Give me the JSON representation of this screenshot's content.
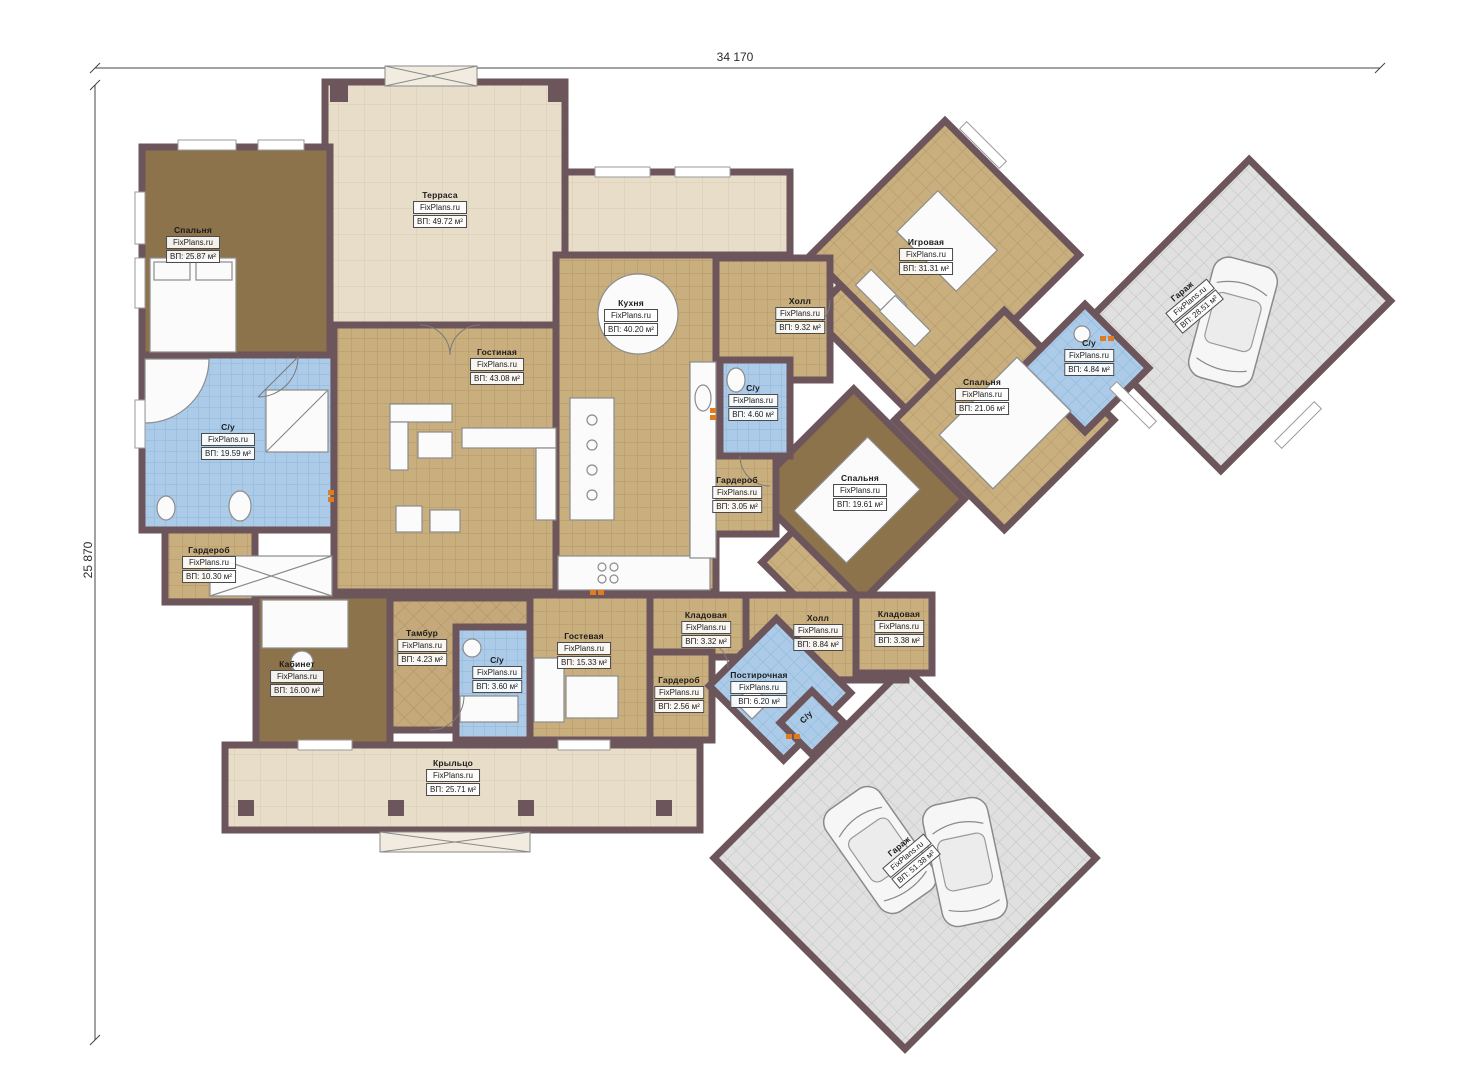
{
  "watermark": "FixPlans.ru",
  "dimensions": {
    "width_label": "34 170",
    "height_label": "25 870"
  },
  "colors": {
    "wall": "#6d565b",
    "tile_floor": "#c9ae7e",
    "bedroom_floor": "#8c734c",
    "bath_floor": "#abcbe9",
    "terrace_floor": "#e8ddc8",
    "garage_floor": "#e0e0e0",
    "marker_orange": "#e07b20"
  },
  "rooms": [
    {
      "name": "Спальня",
      "area": "ВП: 25.87 м²"
    },
    {
      "name": "Терраса",
      "area": "ВП: 49.72 м²"
    },
    {
      "name": "Гостиная",
      "area": "ВП: 43.08 м²"
    },
    {
      "name": "Кухня",
      "area": "ВП: 40.20 м²"
    },
    {
      "name": "Холл",
      "area": "ВП: 9.32 м²"
    },
    {
      "name": "Игровая",
      "area": "ВП: 31.31 м²"
    },
    {
      "name": "С/у",
      "area": "ВП: 4.84 м²"
    },
    {
      "name": "Гараж",
      "area": "ВП: 28.51 м²"
    },
    {
      "name": "Спальня",
      "area": "ВП: 21.06 м²"
    },
    {
      "name": "С/у",
      "area": "ВП: 4.60 м²"
    },
    {
      "name": "Гардероб",
      "area": "ВП: 3.05 м²"
    },
    {
      "name": "Спальня",
      "area": "ВП: 19.61 м²"
    },
    {
      "name": "С/у",
      "area": "ВП: 19.59 м²"
    },
    {
      "name": "Гардероб",
      "area": "ВП: 10.30 м²"
    },
    {
      "name": "Кабинет",
      "area": "ВП: 16.00 м²"
    },
    {
      "name": "Тамбур",
      "area": "ВП: 4.23 м²"
    },
    {
      "name": "С/у",
      "area": "ВП: 3.60 м²"
    },
    {
      "name": "Гостевая",
      "area": "ВП: 15.33 м²"
    },
    {
      "name": "Гардероб",
      "area": "ВП: 2.56 м²"
    },
    {
      "name": "Кладовая",
      "area": "ВП: 3.32 м²"
    },
    {
      "name": "Постирочная",
      "area": "ВП: 6.20 м²"
    },
    {
      "name": "Холл",
      "area": "ВП: 8.84 м²"
    },
    {
      "name": "Кладовая",
      "area": "ВП: 3.38 м²"
    },
    {
      "name": "Крыльцо",
      "area": "ВП: 25.71 м²"
    },
    {
      "name": "Гараж",
      "area": "ВП: 51.38 м²"
    },
    {
      "name": "С/у",
      "area": ""
    }
  ]
}
